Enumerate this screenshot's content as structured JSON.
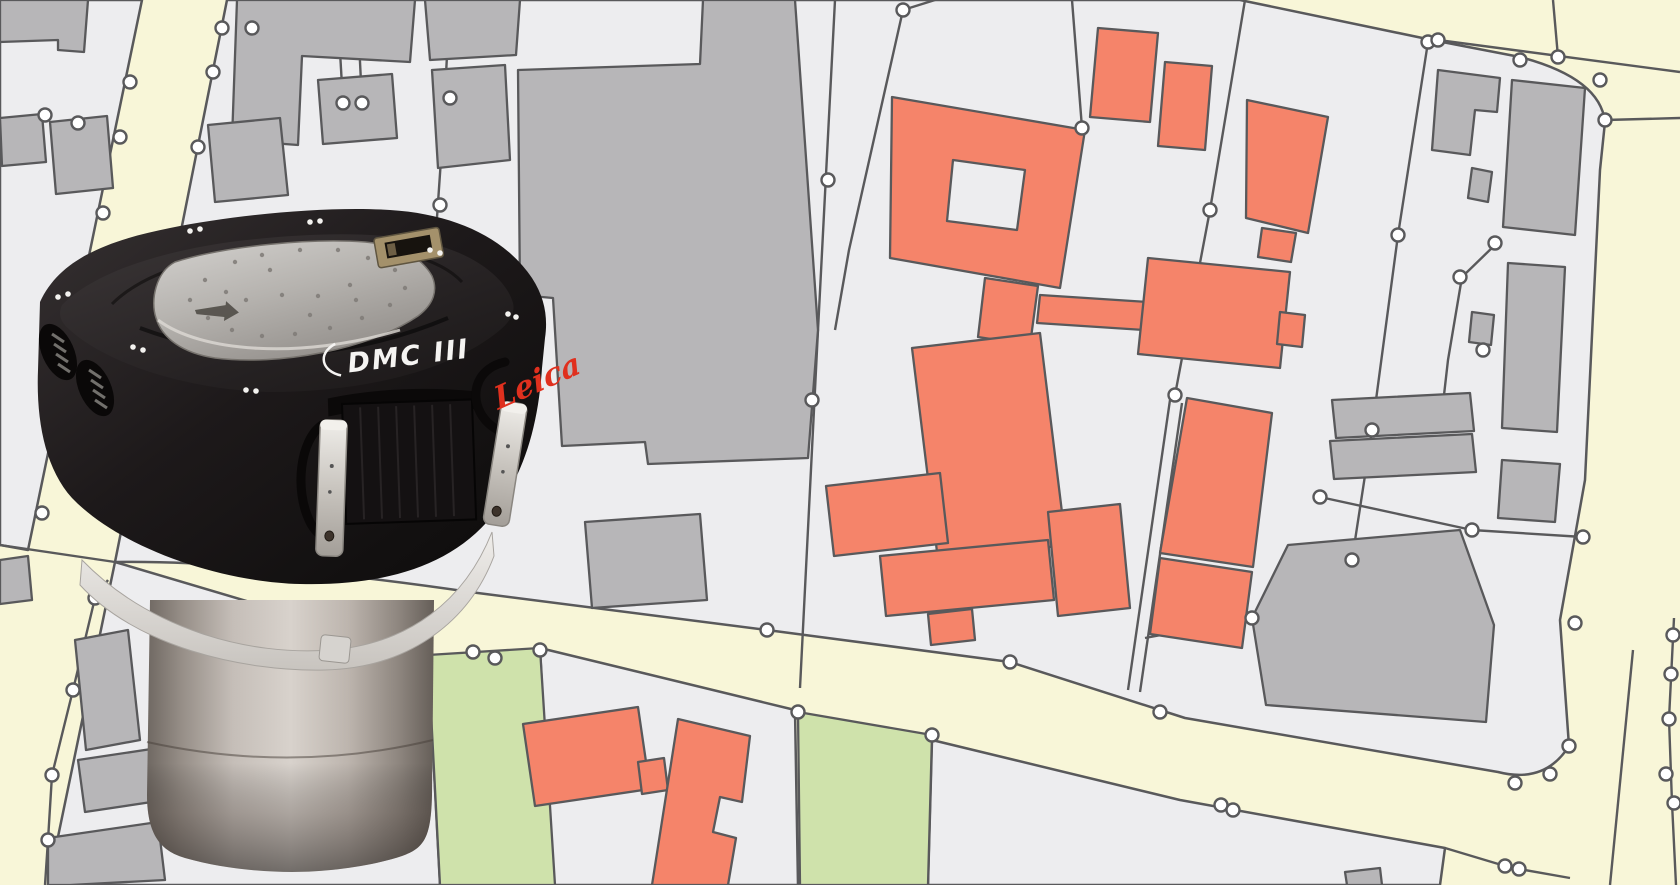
{
  "scene": {
    "type": "product-photo-over-cadastral-map"
  },
  "product": {
    "brand": "Leica",
    "model": "DMC III"
  },
  "map": {
    "features": [
      "road-areas",
      "land-parcels",
      "gray-buildings",
      "orange-buildings",
      "green-spaces",
      "parcel-boundary-lines",
      "survey-point-markers"
    ]
  },
  "palette": {
    "road": "#f8f6d8",
    "parcel": "#ededef",
    "building_gray": "#b7b6b8",
    "building_orange": "#f5846a",
    "green": "#cfe2ab",
    "line": "#59595b",
    "vertex_fill": "#ffffff",
    "camera_black": "#1d191a",
    "barrel_silver": "#c5beb8",
    "leica_red": "#e0301e",
    "label_white": "#f5f4f2"
  }
}
